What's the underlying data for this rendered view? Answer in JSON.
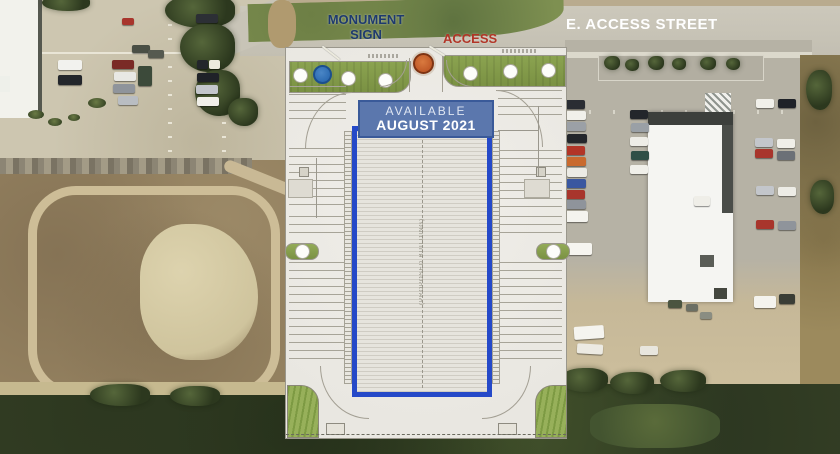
{
  "labels": {
    "monument_sign_line1": "MONUMENT",
    "monument_sign_line2": "SIGN",
    "access": "ACCESS",
    "street": "E. ACCESS STREET",
    "banner_line1": "AVAILABLE",
    "banner_line2": "AUGUST 2021",
    "proposed_building": "(PROPOSED BUILDING)"
  },
  "colors": {
    "accent_blue": "#2549c8",
    "banner_blue": "#5b77ad",
    "banner_border": "#3a5a99",
    "monument_blue": "#2e6cb2",
    "access_orange": "#c05a28",
    "label_navy": "#1e3a6e",
    "label_red": "#b23527",
    "landscape_green": "#8ba350",
    "street_label": "#ffffff"
  }
}
